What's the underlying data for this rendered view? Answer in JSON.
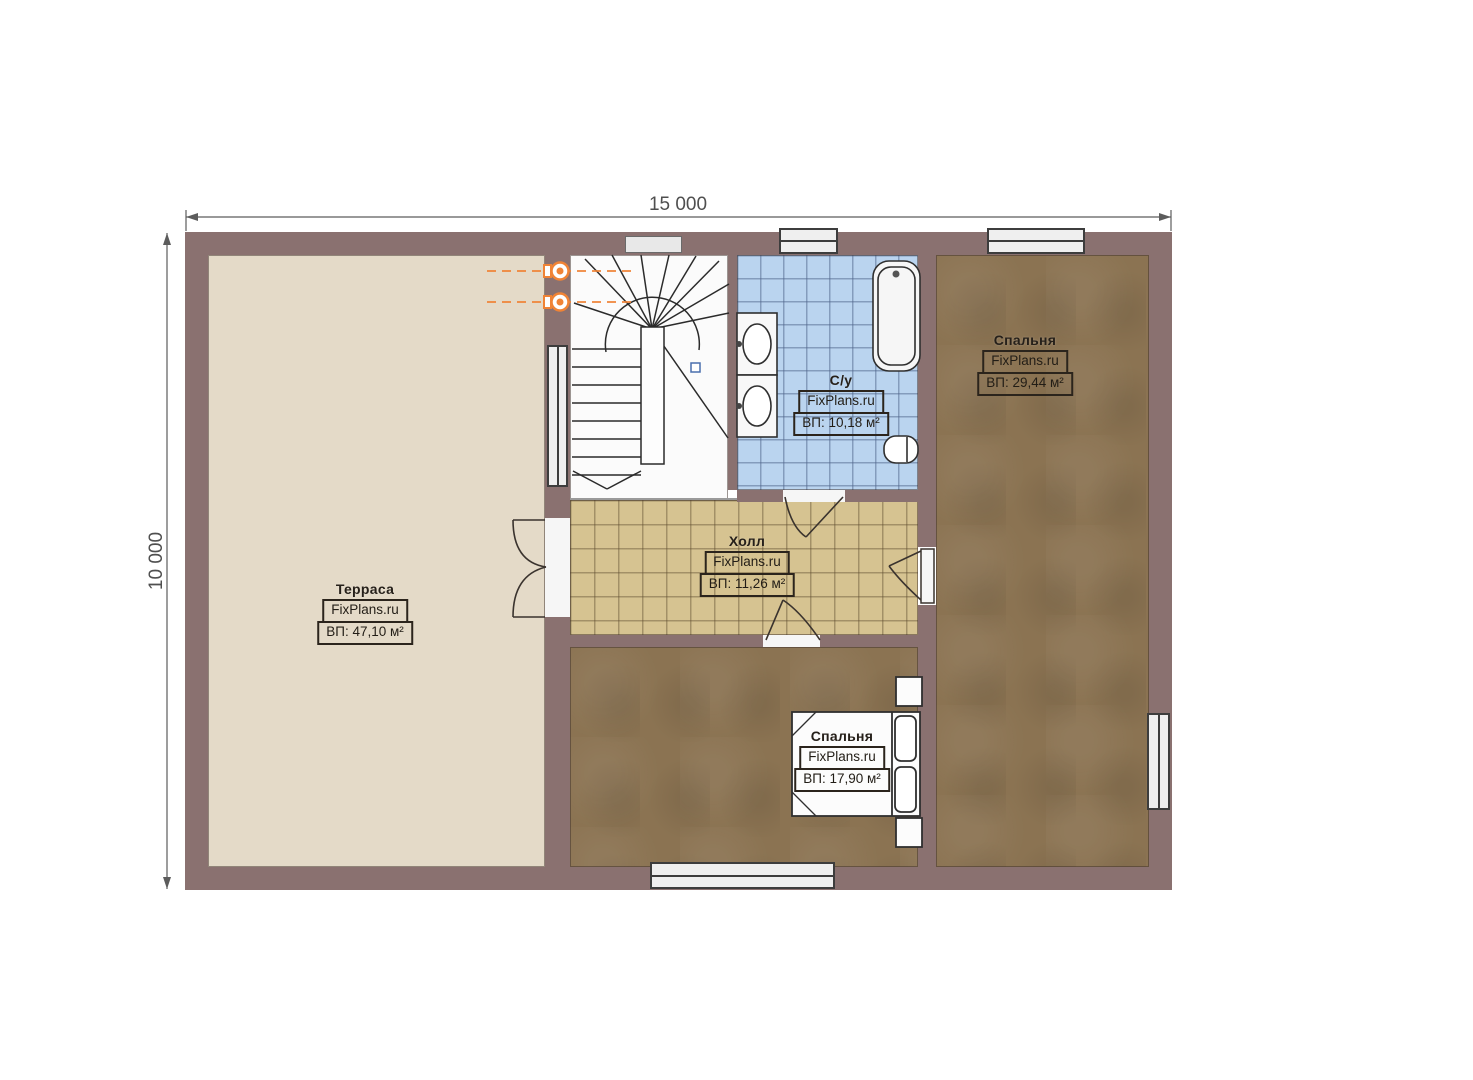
{
  "dimensions": {
    "top_label": "15 000",
    "left_label": "10 000"
  },
  "watermark": "FixPlans.ru",
  "rooms": {
    "terrace": {
      "name": "Терраса",
      "brand": "FixPlans.ru",
      "area": "ВП: 47,10 м²"
    },
    "bedroom_right": {
      "name": "Спальня",
      "brand": "FixPlans.ru",
      "area": "ВП: 29,44 м²"
    },
    "bathroom": {
      "name": "С/у",
      "brand": "FixPlans.ru",
      "area": "ВП: 10,18 м²"
    },
    "hall": {
      "name": "Холл",
      "brand": "FixPlans.ru",
      "area": "ВП: 11,26 м²"
    },
    "bedroom_bottom": {
      "name": "Спальня",
      "brand": "FixPlans.ru",
      "area": "ВП: 17,90 м²"
    }
  },
  "colors": {
    "wall": "#8a7170",
    "terrace_floor": "#e4dac8",
    "bathroom_floor": "#bad4ef",
    "hall_floor": "#d6c391",
    "bedroom_floor": "#8b7352",
    "stairs_floor": "#fbfbfb",
    "window_fill": "#efefef",
    "outline": "#2f2a26",
    "dimension_line": "#5c5c5c",
    "accent_orange": "#f08335",
    "marker_blue": "#4a6fae"
  }
}
